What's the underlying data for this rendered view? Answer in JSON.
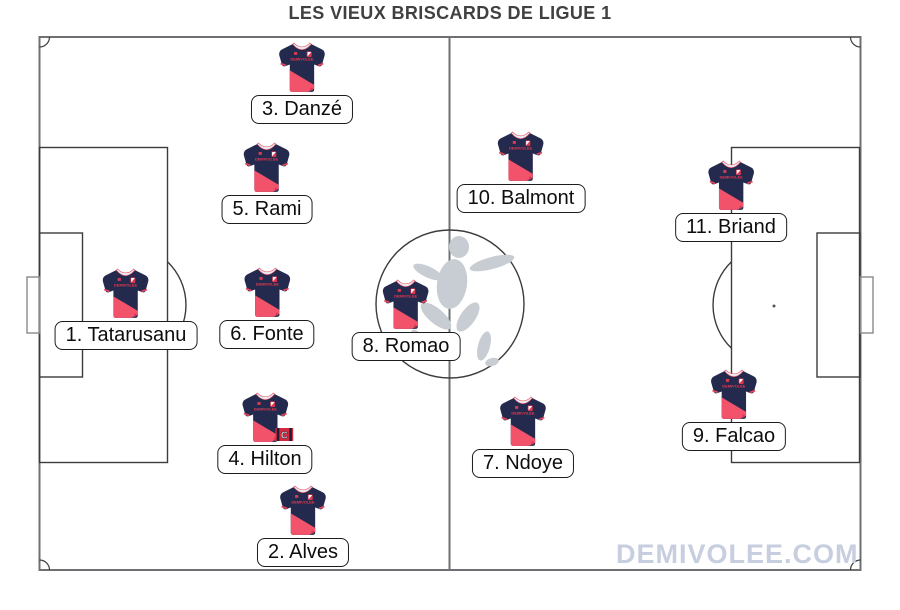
{
  "title": "LES VIEUX BRISCARDS DE LIGUE 1",
  "watermark": "DEMIVOLEE.COM",
  "jersey": {
    "chest_text": "DEMIVOLEE",
    "body_color": "#242a4e",
    "accent_color": "#f3536a",
    "trim_color": "#e6455a"
  },
  "captain_badge_letter": "C",
  "pitch": {
    "line_color": "#3c3c3c",
    "border_color": "#6e7073",
    "silhouette_color": "#c8cdd4"
  },
  "players": [
    {
      "label": "1. Tatarusanu"
    },
    {
      "label": "2. Alves"
    },
    {
      "label": "3. Danzé"
    },
    {
      "label": "4. Hilton",
      "captain": true
    },
    {
      "label": "5. Rami"
    },
    {
      "label": "6. Fonte"
    },
    {
      "label": "7. Ndoye"
    },
    {
      "label": "8. Romao"
    },
    {
      "label": "9. Falcao"
    },
    {
      "label": "10. Balmont"
    },
    {
      "label": "11. Briand"
    }
  ]
}
